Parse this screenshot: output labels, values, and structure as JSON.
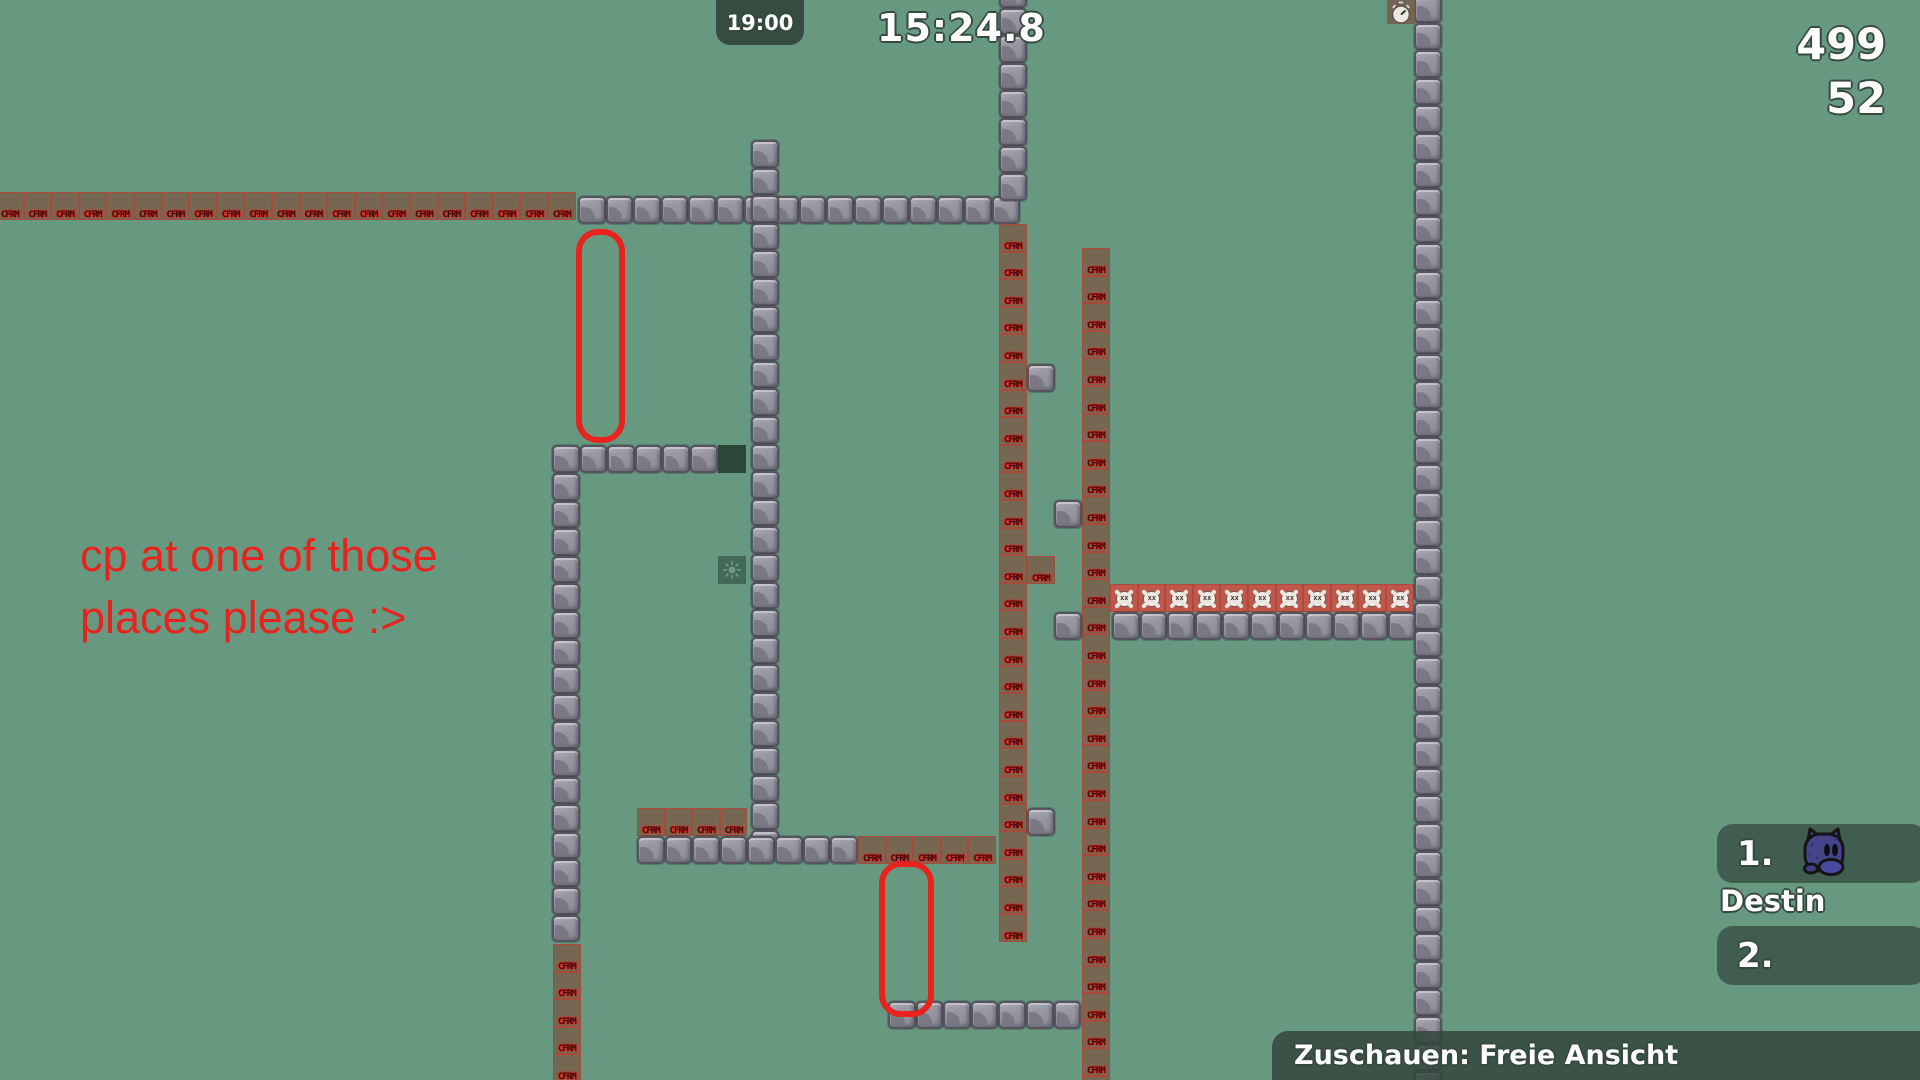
{
  "hud": {
    "server_clock": "19:00",
    "race_timer": "15:24.8",
    "counter_primary": "499",
    "counter_secondary": "52",
    "spectate_bar": "Zuschauen: Freie Ansicht"
  },
  "scoreboard": {
    "rows": [
      {
        "rank": "1.",
        "name": "Destin"
      },
      {
        "rank": "2.",
        "name": ""
      }
    ]
  },
  "annotation": {
    "line1": "cp at one of those",
    "line2": "places please :>",
    "color": "#e8231d",
    "capsules": [
      {
        "x": 576,
        "y": 229,
        "w": 37,
        "h": 202
      },
      {
        "x": 879,
        "y": 861,
        "w": 43,
        "h": 144
      }
    ]
  },
  "map": {
    "tile_size": 27.6,
    "freeze_label": "CFRM",
    "colors": {
      "background": "#679981",
      "hud_green": "#3c5449",
      "freeze_fill": "#76634f",
      "freeze_border": "#c43a2b",
      "freeze_text": "#42070a",
      "kill_fill": "#bf574b",
      "stone_light": "#a7a6af",
      "stone_dark": "#767580",
      "annotation_red": "#e8231d",
      "tee_body": "#45448a"
    },
    "runs": [
      {
        "t": "freeze",
        "x": -4,
        "y": 192,
        "d": "h",
        "n": 21
      },
      {
        "t": "stone",
        "x": 578,
        "y": 196,
        "d": "h",
        "n": 16
      },
      {
        "t": "stone",
        "x": 999,
        "y": -20,
        "d": "v",
        "n": 8
      },
      {
        "t": "stone",
        "x": 751,
        "y": 140,
        "d": "v",
        "n": 26
      },
      {
        "t": "stone",
        "x": 552,
        "y": 445,
        "d": "h",
        "n": 6
      },
      {
        "t": "stone",
        "x": 552,
        "y": 473,
        "d": "v",
        "n": 17
      },
      {
        "t": "freeze",
        "x": 553,
        "y": 944,
        "d": "v",
        "n": 5
      },
      {
        "t": "dark",
        "x": 718,
        "y": 445,
        "d": "h",
        "n": 1
      },
      {
        "t": "sun",
        "x": 718,
        "y": 556,
        "d": "h",
        "n": 1
      },
      {
        "t": "freeze",
        "x": 999,
        "y": 224,
        "d": "v",
        "n": 26
      },
      {
        "t": "freeze",
        "x": 1082,
        "y": 248,
        "d": "v",
        "n": 31
      },
      {
        "t": "freeze",
        "x": 1027,
        "y": 556,
        "d": "h",
        "n": 1
      },
      {
        "t": "stone",
        "x": 1027,
        "y": 364,
        "d": "h",
        "n": 1
      },
      {
        "t": "stone",
        "x": 1054,
        "y": 500,
        "d": "h",
        "n": 1
      },
      {
        "t": "stone",
        "x": 1054,
        "y": 612,
        "d": "h",
        "n": 1
      },
      {
        "t": "stone",
        "x": 1027,
        "y": 808,
        "d": "h",
        "n": 1
      },
      {
        "t": "kill",
        "x": 1110,
        "y": 584,
        "d": "h",
        "n": 11
      },
      {
        "t": "stone",
        "x": 1112,
        "y": 612,
        "d": "h",
        "n": 11
      },
      {
        "t": "freeze",
        "x": 637,
        "y": 808,
        "d": "h",
        "n": 4
      },
      {
        "t": "stone",
        "x": 637,
        "y": 836,
        "d": "h",
        "n": 8
      },
      {
        "t": "freeze",
        "x": 858,
        "y": 836,
        "d": "h",
        "n": 5
      },
      {
        "t": "stone",
        "x": 888,
        "y": 1001,
        "d": "h",
        "n": 7
      },
      {
        "t": "stone",
        "x": 1414,
        "y": -5,
        "d": "v",
        "n": 40
      },
      {
        "t": "stopwatch",
        "x": 1387,
        "y": 0,
        "d": "h",
        "n": 1
      }
    ]
  }
}
